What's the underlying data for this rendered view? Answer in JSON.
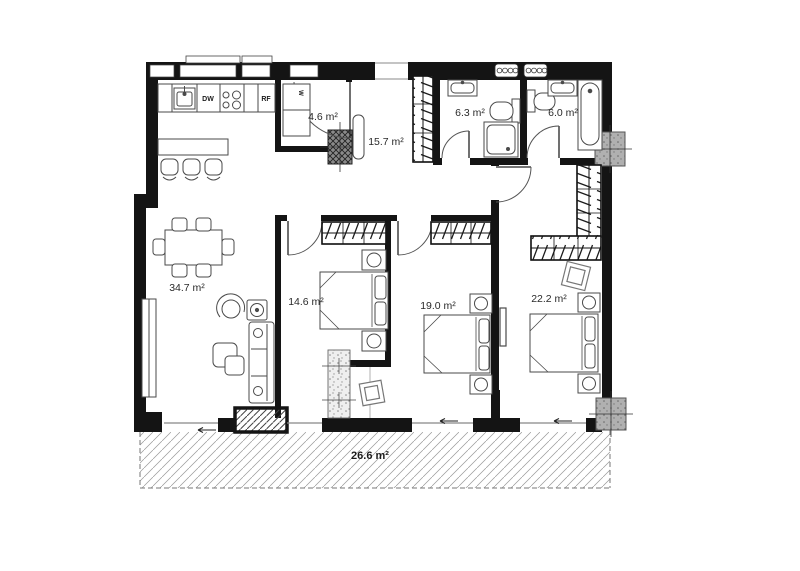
{
  "plan": {
    "rooms": [
      {
        "id": "living-kitchen",
        "area_label": "34.7 m²"
      },
      {
        "id": "laundry",
        "area_label": "4.6 m²"
      },
      {
        "id": "hallway",
        "area_label": "15.7 m²"
      },
      {
        "id": "bathroom-1",
        "area_label": "6.3 m²"
      },
      {
        "id": "bathroom-2",
        "area_label": "6.0 m²"
      },
      {
        "id": "bedroom-1",
        "area_label": "14.6 m²"
      },
      {
        "id": "bedroom-2",
        "area_label": "19.0 m²"
      },
      {
        "id": "bedroom-3",
        "area_label": "22.2 m²"
      },
      {
        "id": "terrace",
        "area_label": "26.6 m²"
      }
    ],
    "appliances": {
      "dishwasher_label": "DW",
      "refrigerator_label": "RF",
      "washer_label": "W"
    },
    "colors": {
      "wall": "#141414",
      "furniture_stroke": "#4a4a4a",
      "label_text": "#2a2a2a",
      "terrace_hatch": "#999999",
      "concrete_column": "#b0b0b0"
    }
  }
}
